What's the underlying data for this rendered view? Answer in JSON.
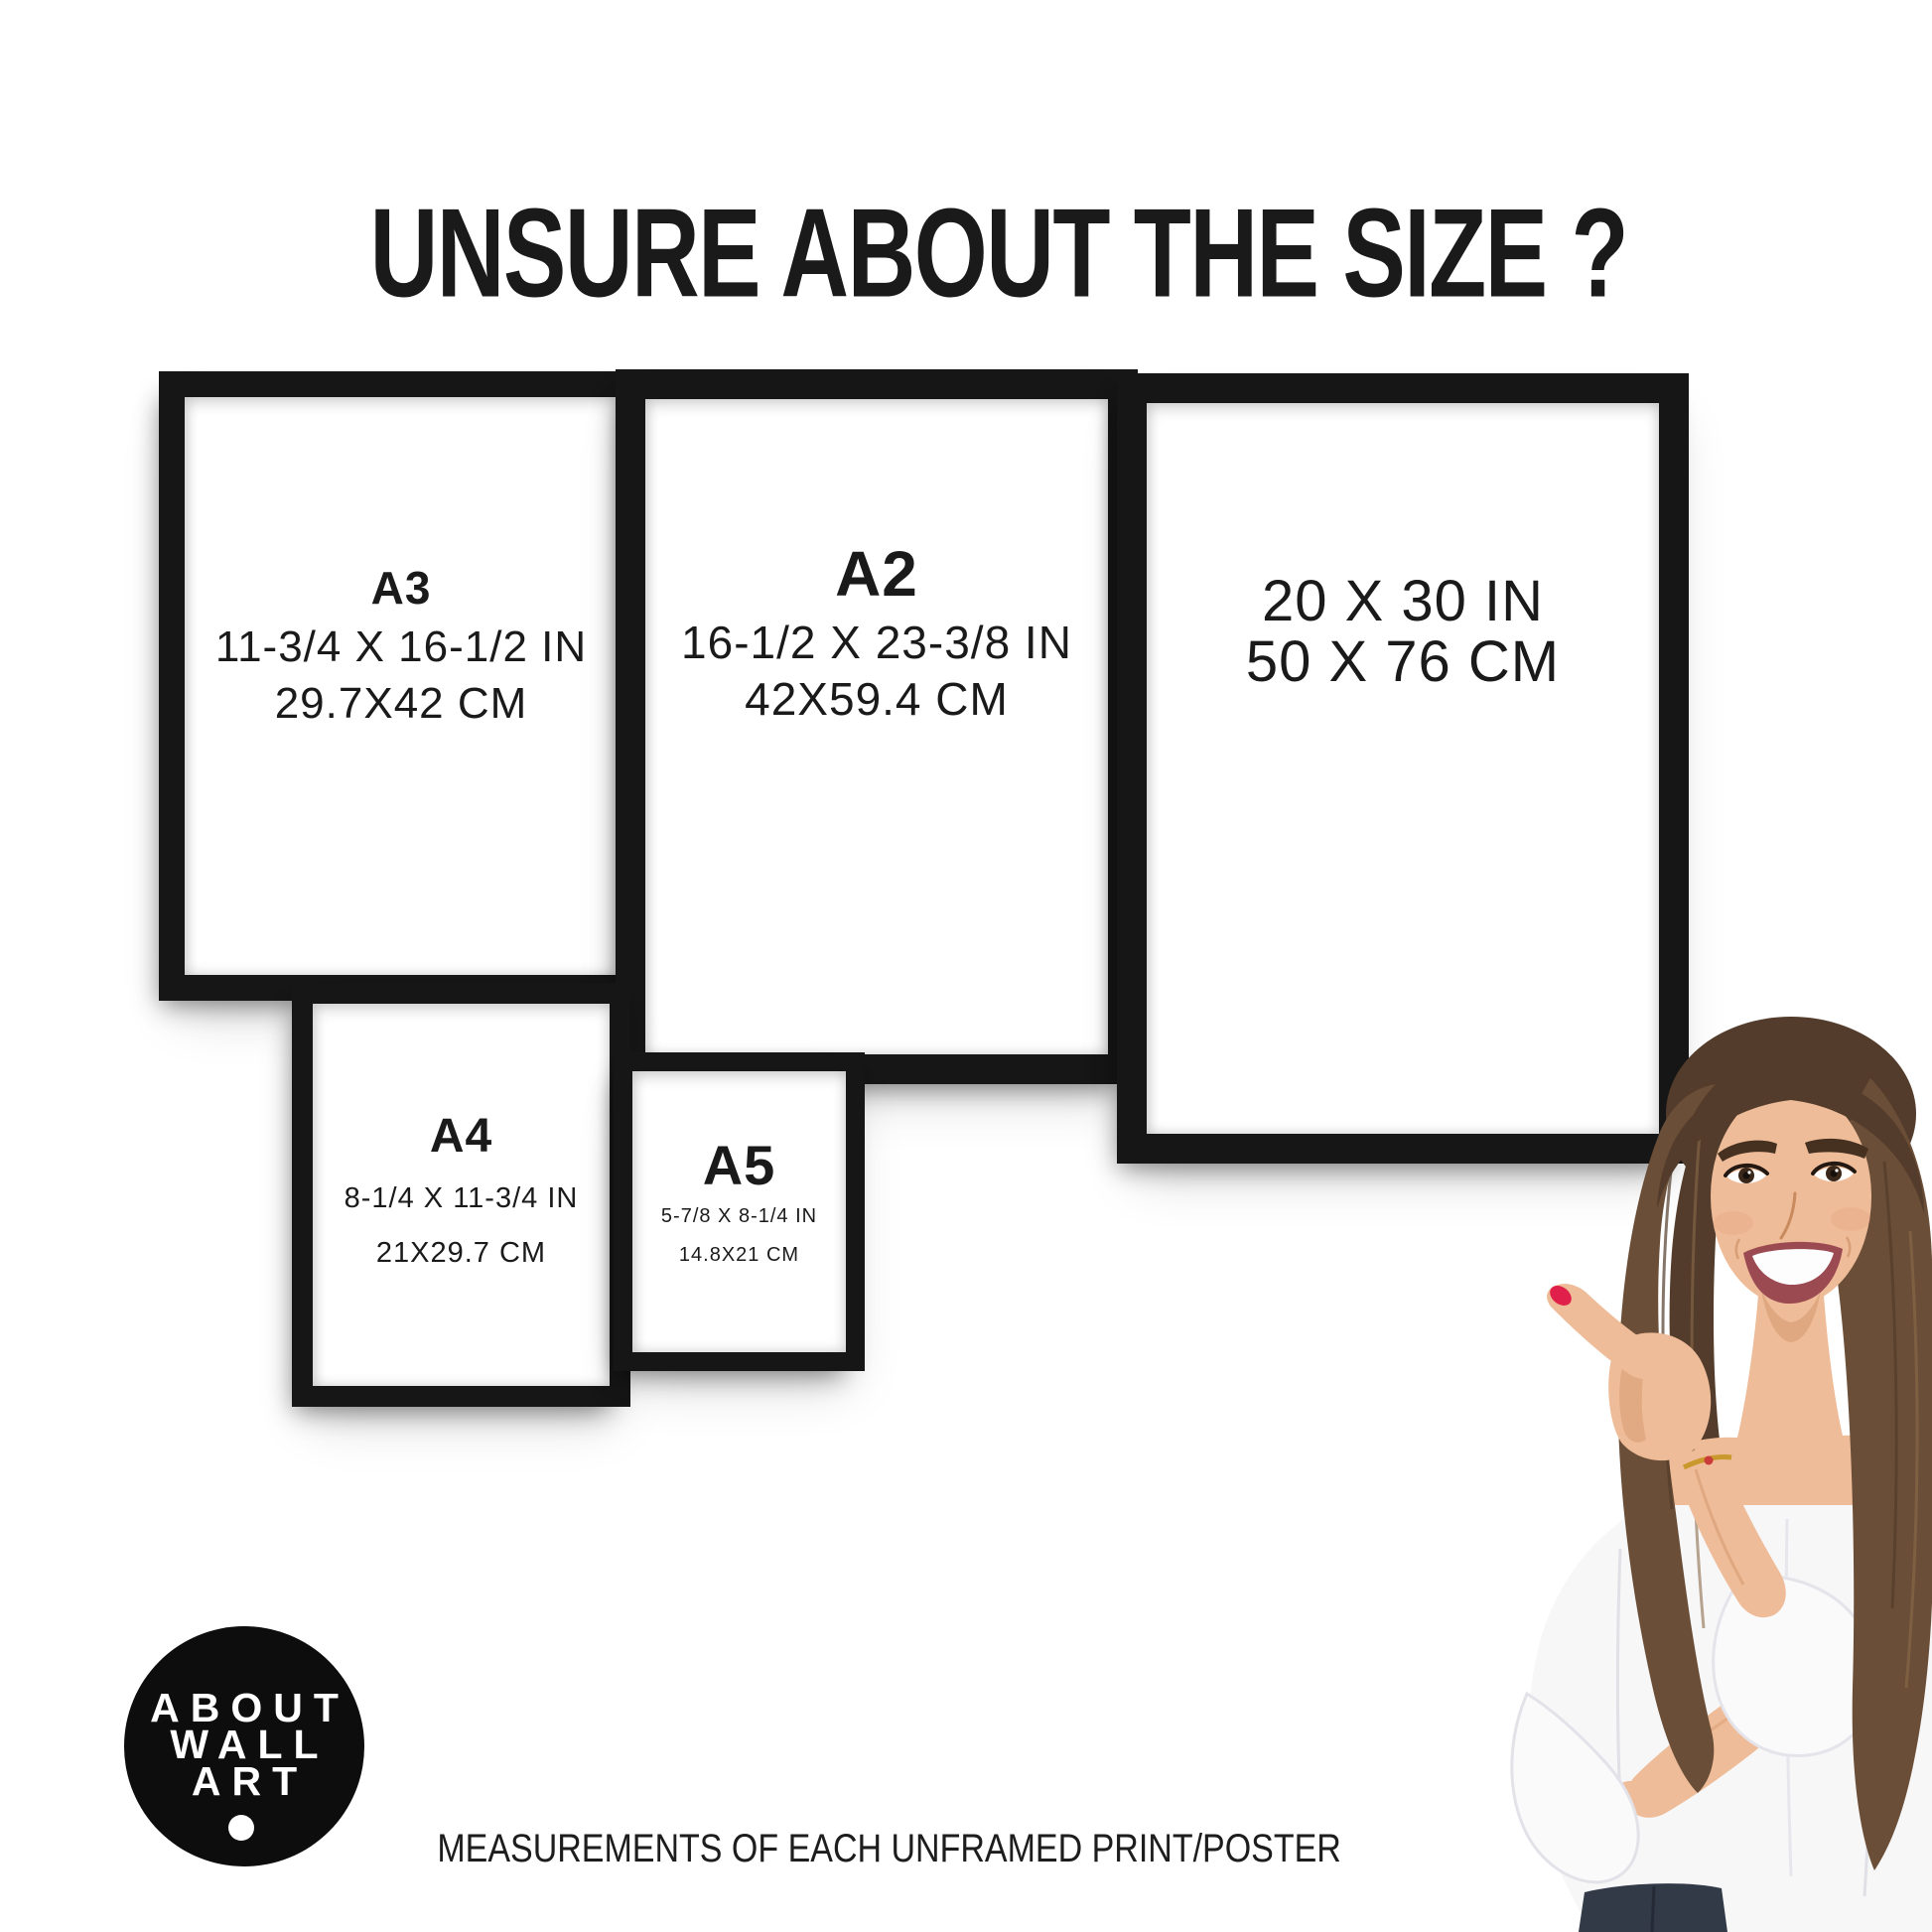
{
  "title": "UNSURE ABOUT THE SIZE ?",
  "frames": [
    {
      "id": "a3",
      "label": "A3",
      "inches": "11-3/4 X 16-1/2 IN",
      "cm": "29.7X42 CM"
    },
    {
      "id": "a2",
      "label": "A2",
      "inches": "16-1/2 X 23-3/8 IN",
      "cm": "42X59.4 CM"
    },
    {
      "id": "20x30",
      "label": "",
      "inches": "20 X 30 IN",
      "cm": "50 X 76 CM"
    },
    {
      "id": "a4",
      "label": "A4",
      "inches": "8-1/4 X 11-3/4 IN",
      "cm": "21X29.7 CM"
    },
    {
      "id": "a5",
      "label": "A5",
      "inches": "5-7/8 X 8-1/4 IN",
      "cm": "14.8X21 CM"
    }
  ],
  "logo": {
    "line1": "ABOUT",
    "line2": "WALL",
    "line3": "ART"
  },
  "footer_caption": "MEASUREMENTS OF EACH UNFRAMED PRINT/POSTER",
  "colors": {
    "background": "#ffffff",
    "frame_black": "#161616",
    "text_black": "#1a1a1a",
    "logo_black": "#0d0d0d",
    "nail_red": "#e0204a"
  }
}
